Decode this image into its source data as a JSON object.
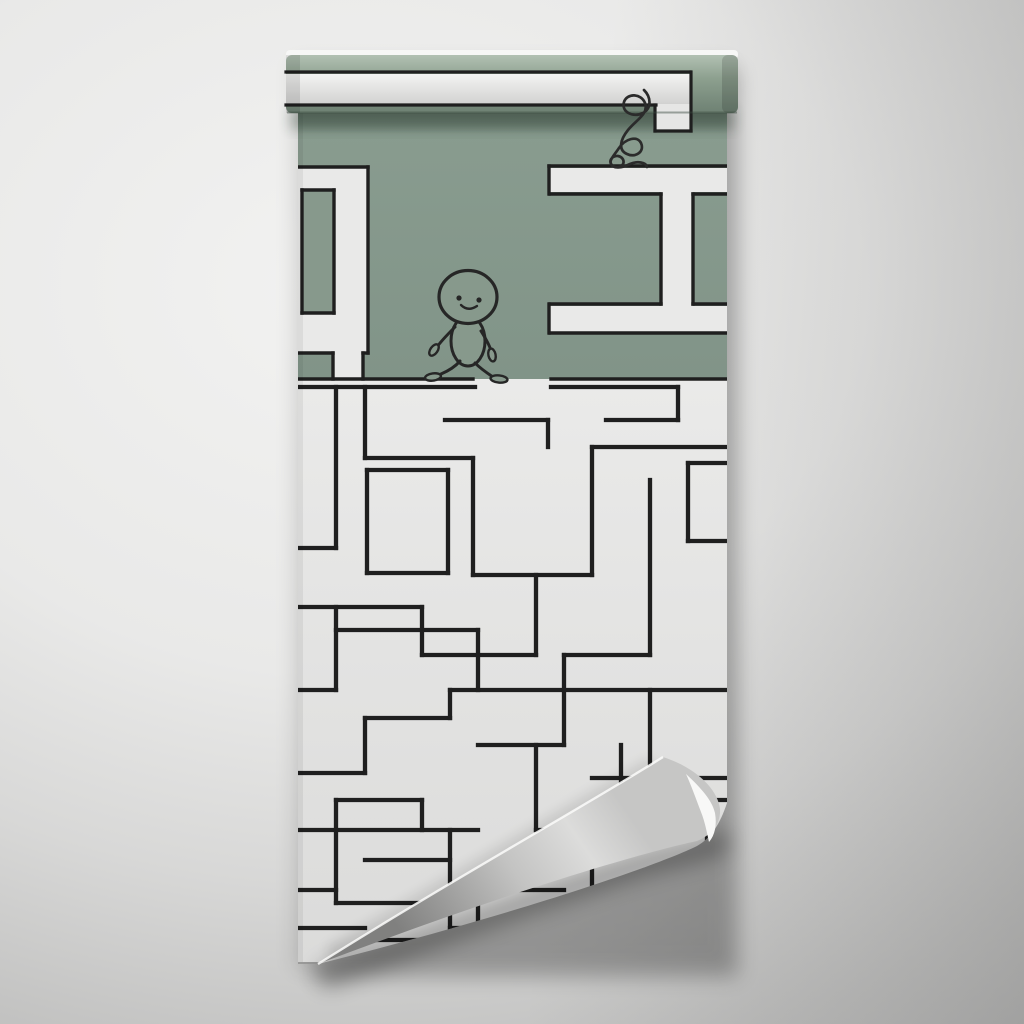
{
  "scene": {
    "kind": "wallpaper-roll-mockup",
    "canvas": {
      "w": 1024,
      "h": 1024
    }
  },
  "colors": {
    "bg_center": "#efefee",
    "bg_edge": "#ababaa",
    "green": "#87998c",
    "green_top": "#8b9e91",
    "green_bottom": "#819488",
    "roll_green_light": "#b2c1b3",
    "roll_green_mid": "#8da08f",
    "roll_green_dark": "#6e8173",
    "path_white": "#e9e9e8",
    "band_top": "#f3f3f2",
    "band_bottom": "#d2d2d1",
    "roll_strip": "#f7f7f6",
    "maze_line": "#1f1f1f",
    "sheet_white_top": "#eaeae9",
    "sheet_white_bottom": "#dbdbda",
    "cone_dark": "#80807f",
    "cone_mid": "#c3c3c2",
    "cone_light": "#dcdcdb",
    "crescent": "#f8f8f7",
    "character_line": "#262626"
  },
  "sheet": {
    "x": 298,
    "y": 55,
    "w": 429,
    "h": 909,
    "split_y": 379,
    "clip": "M298,55 L727,55 L727,803 C720,824 711,838 697,846 C652,868 505,917 318,964 L298,964 Z"
  },
  "roll": {
    "strip": {
      "x": 286,
      "y": 50,
      "w": 452,
      "h": 9
    },
    "body": {
      "x": 286,
      "y": 55,
      "w": 452,
      "h": 58
    },
    "band": {
      "x": 286,
      "y": 74,
      "w": 404,
      "h": 30
    },
    "stub": {
      "x": 656,
      "y": 104,
      "w": 34,
      "h": 27
    },
    "lines": [
      [
        286,
        72,
        690,
        72
      ],
      [
        286,
        105,
        656,
        105
      ],
      [
        655,
        105,
        655,
        131
      ],
      [
        655,
        131,
        691,
        131
      ],
      [
        691,
        72,
        691,
        131
      ]
    ]
  },
  "green_area": {
    "whites": [
      [
        298,
        168,
        70,
        185
      ],
      [
        333,
        353,
        30,
        27
      ],
      [
        550,
        168,
        177,
        24
      ],
      [
        661,
        192,
        32,
        114
      ],
      [
        550,
        306,
        177,
        26
      ]
    ],
    "holes": [
      [
        302,
        190,
        32,
        123
      ]
    ],
    "lines": [
      [
        298,
        167,
        368,
        167
      ],
      [
        368,
        167,
        368,
        353
      ],
      [
        298,
        353,
        333,
        353
      ],
      [
        363,
        353,
        368,
        353
      ],
      [
        333,
        353,
        333,
        379
      ],
      [
        363,
        353,
        363,
        379
      ],
      [
        302,
        190,
        334,
        190
      ],
      [
        334,
        190,
        334,
        313
      ],
      [
        302,
        313,
        334,
        313
      ],
      [
        302,
        190,
        302,
        313
      ],
      [
        549,
        166,
        727,
        166
      ],
      [
        549,
        166,
        549,
        194
      ],
      [
        550,
        194,
        661,
        194
      ],
      [
        693,
        194,
        727,
        194
      ],
      [
        661,
        194,
        661,
        304
      ],
      [
        693,
        194,
        693,
        304
      ],
      [
        549,
        304,
        549,
        333
      ],
      [
        550,
        304,
        661,
        304
      ],
      [
        693,
        304,
        727,
        304
      ],
      [
        550,
        333,
        727,
        333
      ],
      [
        298,
        379,
        473,
        379
      ],
      [
        551,
        379,
        727,
        379
      ]
    ]
  },
  "white_area": {
    "stroke_width": 4.3,
    "walls_h": [
      [
        298,
        387,
        475
      ],
      [
        551,
        387,
        678
      ],
      [
        365,
        458,
        473
      ],
      [
        445,
        420,
        548
      ],
      [
        606,
        420,
        678
      ],
      [
        592,
        447,
        727
      ],
      [
        367,
        470,
        448
      ],
      [
        367,
        573,
        448
      ],
      [
        298,
        548,
        336
      ],
      [
        298,
        607,
        422
      ],
      [
        336,
        630,
        478
      ],
      [
        473,
        575,
        592
      ],
      [
        422,
        655,
        536
      ],
      [
        564,
        655,
        650
      ],
      [
        298,
        690,
        336
      ],
      [
        450,
        690,
        727
      ],
      [
        365,
        718,
        450
      ],
      [
        478,
        745,
        564
      ],
      [
        298,
        773,
        365
      ],
      [
        592,
        778,
        727
      ],
      [
        336,
        800,
        422
      ],
      [
        650,
        800,
        727
      ],
      [
        298,
        830,
        478
      ],
      [
        536,
        830,
        621
      ],
      [
        365,
        860,
        450
      ],
      [
        298,
        890,
        336
      ],
      [
        478,
        890,
        564
      ],
      [
        336,
        903,
        422
      ],
      [
        298,
        928,
        365
      ],
      [
        450,
        928,
        536
      ],
      [
        365,
        940,
        450
      ],
      [
        688,
        463,
        727
      ],
      [
        688,
        541,
        727
      ]
    ],
    "walls_v": [
      [
        336,
        387,
        548
      ],
      [
        365,
        387,
        458
      ],
      [
        473,
        458,
        575
      ],
      [
        548,
        420,
        447
      ],
      [
        367,
        470,
        573
      ],
      [
        448,
        470,
        573
      ],
      [
        592,
        447,
        575
      ],
      [
        536,
        575,
        655
      ],
      [
        650,
        480,
        655
      ],
      [
        678,
        387,
        420
      ],
      [
        688,
        463,
        541
      ],
      [
        422,
        607,
        655
      ],
      [
        478,
        630,
        690
      ],
      [
        564,
        655,
        745
      ],
      [
        621,
        745,
        830
      ],
      [
        650,
        690,
        778
      ],
      [
        707,
        800,
        860
      ],
      [
        336,
        607,
        690
      ],
      [
        336,
        800,
        903
      ],
      [
        365,
        718,
        773
      ],
      [
        450,
        690,
        718
      ],
      [
        450,
        830,
        940
      ],
      [
        536,
        745,
        830
      ],
      [
        592,
        860,
        928
      ],
      [
        478,
        890,
        928
      ],
      [
        422,
        800,
        830
      ]
    ]
  },
  "walker": {
    "head": {
      "cx": 468,
      "cy": 297,
      "rx": 29,
      "ry": 26.5
    },
    "body": {
      "cx": 468,
      "cy": 341,
      "rx": 17,
      "ry": 25
    },
    "eyes": [
      [
        459,
        298
      ],
      [
        479,
        300
      ]
    ],
    "smile": "M461,305 Q468,312 477,306",
    "arms": [
      "M455,327 C448,334 441,341 437,347",
      "M481,331 C486,339 490,346 491,351"
    ],
    "hands": [
      {
        "cx": 434,
        "cy": 350,
        "rx": 3.6,
        "ry": 6.5,
        "rot": 35
      },
      {
        "cx": 492,
        "cy": 355,
        "rx": 3.6,
        "ry": 6.5,
        "rot": -12
      }
    ],
    "legs": [
      "M460,361 C455,367 448,371 441,374",
      "M475,363 C481,369 487,373 493,377"
    ],
    "feet": [
      {
        "cx": 433,
        "cy": 377,
        "rx": 8,
        "ry": 3.6,
        "rot": -8
      },
      {
        "cx": 499,
        "cy": 379,
        "rx": 8.5,
        "ry": 3.6,
        "rot": 6
      }
    ]
  },
  "tangled": {
    "path": "M644,90 C651,97 652,108 643,113 C633,118 621,112 624,102 C627,93 641,93 645,103 C649,114 636,120 628,130 C620,140 618,150 627,154 C635,158 645,152 641,143 C637,135 625,139 619,148 C613,157 607,162 613,166 C619,170 627,164 622,158 C617,153 608,158 611,164 C613,169 622,168 630,164 C637,161 646,162 647,167"
  },
  "curl": {
    "cone": "M663,757 C595,800 455,878 318,964 C395,935 470,908 545,884 C610,863 668,847 697,841 C712,835 721,823 720,809 C718,790 697,768 663,757 Z",
    "crescent": "M686,774 C701,788 712,800 715,813 C717,825 715,835 709,842 C707,833 705,822 701,812 C696,799 691,785 686,774 Z",
    "edge_highlight": "M663,757 C595,800 455,878 318,964",
    "shadow_path": "M330,975 C420,940 540,898 640,865 C680,853 705,850 716,843",
    "sheet_shadow_path": "M655,765 C580,810 450,885 330,955"
  }
}
